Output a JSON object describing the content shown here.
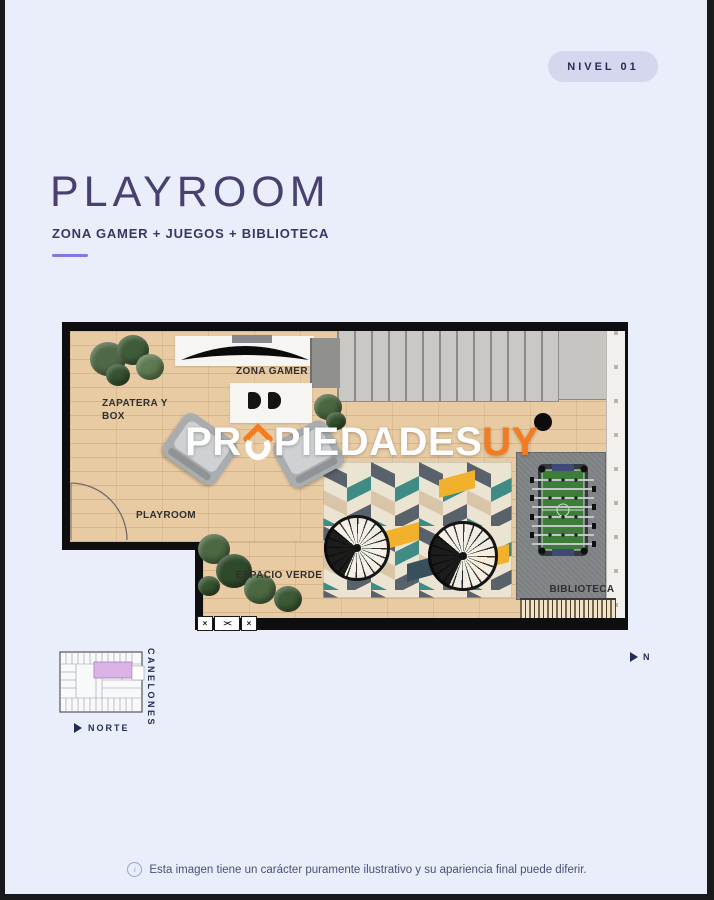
{
  "theme": {
    "background": "#e9eefa",
    "frame": "#19191d",
    "accent_purple": "#8478de",
    "badge_bg": "#d4d7ee",
    "badge_text": "#2e2a56",
    "title_color": "#494071",
    "navy": "#232c57",
    "watermark_orange": "#f47b20",
    "unit_highlight_pink": "#dbb3e6"
  },
  "header": {
    "level_badge": "NIVEL 01"
  },
  "hero": {
    "title": "PLAYROOM",
    "subtitle": "ZONA GAMER + JUEGOS + BIBLIOTECA"
  },
  "floorplan": {
    "room_labels": {
      "zona_gamer": "ZONA GAMER",
      "zapatera_box": "ZAPATERA Y BOX",
      "playroom": "PLAYROOM",
      "espacio_verde": "ESPACIO VERDE",
      "biblioteca": "BIBLIOTECA"
    },
    "watermark": {
      "prefix": "PR",
      "middle": "PIEDADES",
      "suffix": "UY"
    },
    "window_symbols": [
      "×",
      "><",
      "×"
    ]
  },
  "locator": {
    "street": "CANELONES",
    "north": "NORTE"
  },
  "compass": {
    "north": "N"
  },
  "footer": {
    "info_glyph": "i",
    "disclaimer": "Esta imagen tiene un carácter puramente ilustrativo y su apariencia final puede diferir."
  }
}
